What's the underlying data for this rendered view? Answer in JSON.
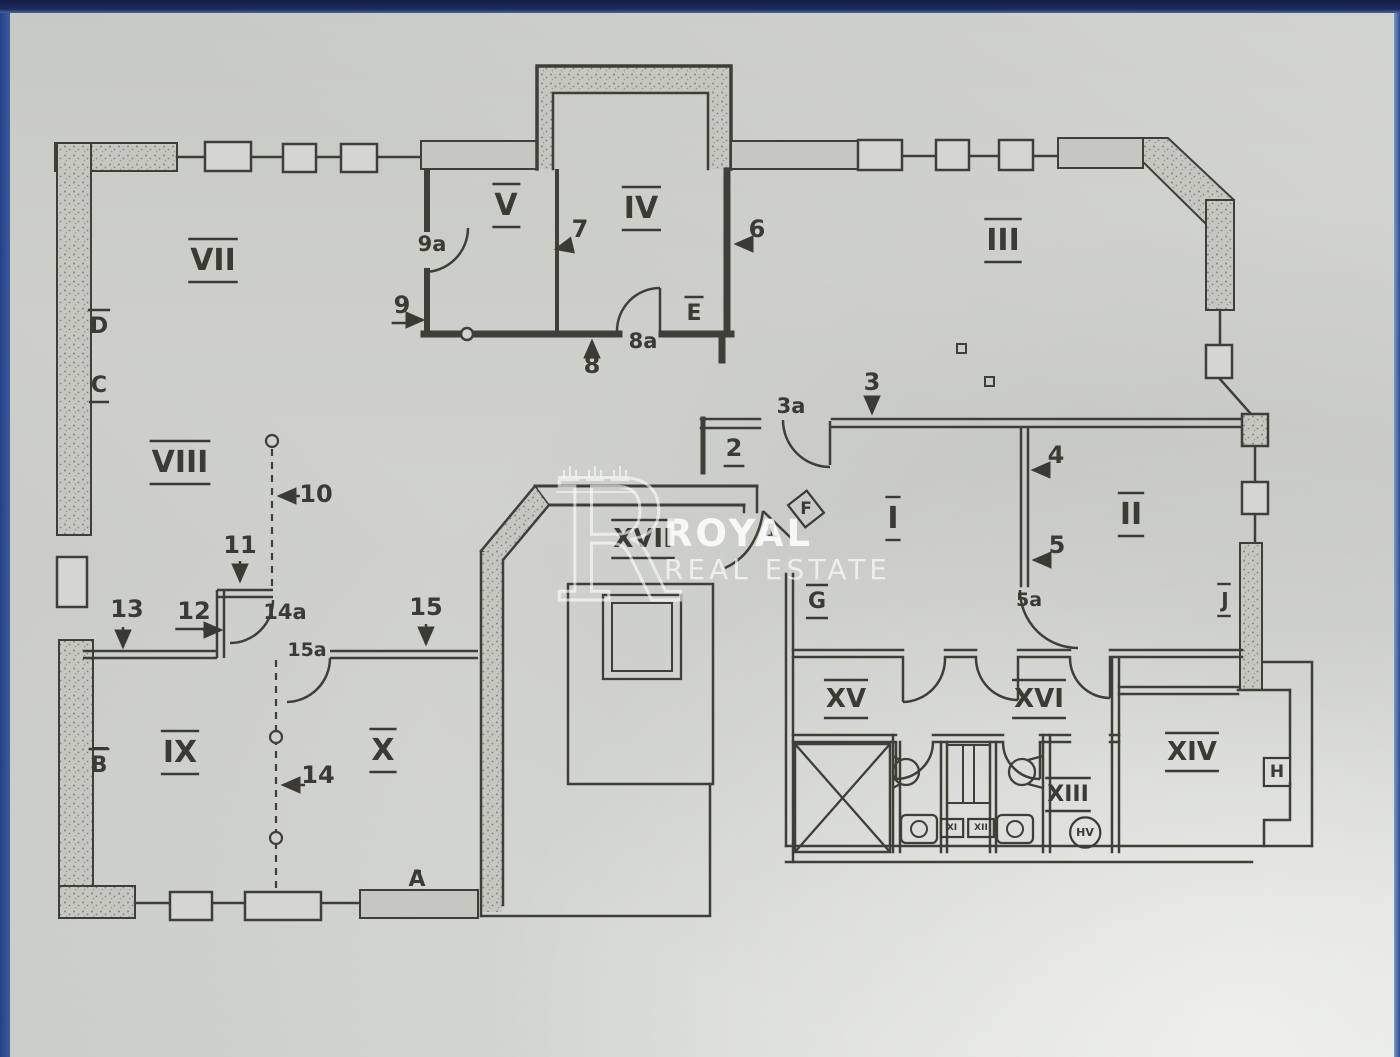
{
  "page": {
    "kind": "scanned floor plan photo",
    "frame_color_top": "#1c2b5e",
    "frame_color_side": "#2b4a8f",
    "paper_color": "#d2d3ce",
    "ink_color": "#3b3b34"
  },
  "watermark": {
    "monogram": "R",
    "crown_count": 3,
    "line1": "ROYAL",
    "line2": "REAL ESTATE"
  },
  "plan": {
    "room_labels": [
      "VII",
      "VIII",
      "IX",
      "X",
      "V",
      "IV",
      "III",
      "I",
      "II",
      "XVII",
      "XV",
      "XVI",
      "XIII",
      "XIV"
    ],
    "door_window_marks": [
      "A",
      "B",
      "C",
      "D",
      "E",
      "F",
      "G",
      "H",
      "J",
      "HV",
      "XI",
      "XII"
    ],
    "position_numbers": [
      "1",
      "2",
      "3",
      "3a",
      "4",
      "5",
      "5a",
      "6",
      "7",
      "8",
      "8a",
      "9",
      "9a",
      "10",
      "11",
      "12",
      "13",
      "14",
      "14a",
      "15",
      "15a"
    ],
    "labels": [
      {
        "t": "VII",
        "x": 213,
        "y": 270,
        "fs": 30,
        "d": "ou"
      },
      {
        "t": "VIII",
        "x": 180,
        "y": 472,
        "fs": 30,
        "d": "ou"
      },
      {
        "t": "IX",
        "x": 180,
        "y": 762,
        "fs": 30,
        "d": "ou"
      },
      {
        "t": "X",
        "x": 383,
        "y": 760,
        "fs": 30,
        "d": "ou"
      },
      {
        "t": "V",
        "x": 506,
        "y": 215,
        "fs": 30,
        "d": "ou"
      },
      {
        "t": "IV",
        "x": 641,
        "y": 218,
        "fs": 30,
        "d": "ou"
      },
      {
        "t": "III",
        "x": 1003,
        "y": 250,
        "fs": 30,
        "d": "ou"
      },
      {
        "t": "I",
        "x": 893,
        "y": 528,
        "fs": 30,
        "d": "ou"
      },
      {
        "t": "II",
        "x": 1131,
        "y": 524,
        "fs": 30,
        "d": "ou"
      },
      {
        "t": "XVII",
        "x": 643,
        "y": 547,
        "fs": 26,
        "d": "ou"
      },
      {
        "t": "XV",
        "x": 846,
        "y": 707,
        "fs": 26,
        "d": "ou"
      },
      {
        "t": "XVI",
        "x": 1039,
        "y": 707,
        "fs": 26,
        "d": "ou"
      },
      {
        "t": "XIII",
        "x": 1068,
        "y": 801,
        "fs": 22,
        "d": "ou"
      },
      {
        "t": "XIV",
        "x": 1192,
        "y": 760,
        "fs": 26,
        "d": "ou"
      },
      {
        "t": "D",
        "x": 99,
        "y": 333,
        "fs": 22,
        "d": "o"
      },
      {
        "t": "C",
        "x": 99,
        "y": 392,
        "fs": 22,
        "d": "u"
      },
      {
        "t": "B",
        "x": 99,
        "y": 772,
        "fs": 22,
        "d": "o"
      },
      {
        "t": "A",
        "x": 417,
        "y": 886,
        "fs": 22,
        "d": "n"
      },
      {
        "t": "E",
        "x": 694,
        "y": 320,
        "fs": 22,
        "d": "o"
      },
      {
        "t": "G",
        "x": 817,
        "y": 608,
        "fs": 22,
        "d": "ou"
      },
      {
        "t": "J",
        "x": 1225,
        "y": 607,
        "fs": 20,
        "d": "ou"
      },
      {
        "t": "H",
        "x": 1277,
        "y": 777,
        "fs": 17,
        "d": "box"
      },
      {
        "t": "F",
        "x": 806,
        "y": 514,
        "fs": 17,
        "d": "dia"
      },
      {
        "t": "HV",
        "x": 1085,
        "y": 836,
        "fs": 11,
        "d": "cir"
      },
      {
        "t": "XI",
        "x": 952,
        "y": 830,
        "fs": 9,
        "d": "box"
      },
      {
        "t": "XII",
        "x": 981,
        "y": 830,
        "fs": 9,
        "d": "box"
      },
      {
        "t": "1",
        "x": 772,
        "y": 537,
        "fs": 19,
        "d": "n"
      },
      {
        "t": "2",
        "x": 734,
        "y": 456,
        "fs": 24,
        "d": "u"
      },
      {
        "t": "3",
        "x": 872,
        "y": 390,
        "fs": 24,
        "d": "n"
      },
      {
        "t": "3a",
        "x": 791,
        "y": 413,
        "fs": 21,
        "d": "n"
      },
      {
        "t": "4",
        "x": 1056,
        "y": 463,
        "fs": 24,
        "d": "n"
      },
      {
        "t": "5",
        "x": 1057,
        "y": 553,
        "fs": 24,
        "d": "n"
      },
      {
        "t": "5a",
        "x": 1029,
        "y": 606,
        "fs": 19,
        "d": "n"
      },
      {
        "t": "6",
        "x": 757,
        "y": 237,
        "fs": 24,
        "d": "n"
      },
      {
        "t": "7",
        "x": 580,
        "y": 237,
        "fs": 24,
        "d": "n"
      },
      {
        "t": "8",
        "x": 592,
        "y": 373,
        "fs": 24,
        "d": "n"
      },
      {
        "t": "8a",
        "x": 643,
        "y": 348,
        "fs": 21,
        "d": "n"
      },
      {
        "t": "9",
        "x": 402,
        "y": 313,
        "fs": 24,
        "d": "u"
      },
      {
        "t": "9a",
        "x": 432,
        "y": 251,
        "fs": 21,
        "d": "n"
      },
      {
        "t": "10",
        "x": 316,
        "y": 502,
        "fs": 24,
        "d": "n"
      },
      {
        "t": "11",
        "x": 240,
        "y": 553,
        "fs": 24,
        "d": "n"
      },
      {
        "t": "12",
        "x": 194,
        "y": 619,
        "fs": 24,
        "d": "u"
      },
      {
        "t": "13",
        "x": 127,
        "y": 617,
        "fs": 24,
        "d": "n"
      },
      {
        "t": "14",
        "x": 318,
        "y": 783,
        "fs": 24,
        "d": "n"
      },
      {
        "t": "14a",
        "x": 285,
        "y": 619,
        "fs": 21,
        "d": "n"
      },
      {
        "t": "15",
        "x": 426,
        "y": 615,
        "fs": 24,
        "d": "n"
      },
      {
        "t": "15a",
        "x": 307,
        "y": 656,
        "fs": 19,
        "d": "n"
      }
    ]
  }
}
